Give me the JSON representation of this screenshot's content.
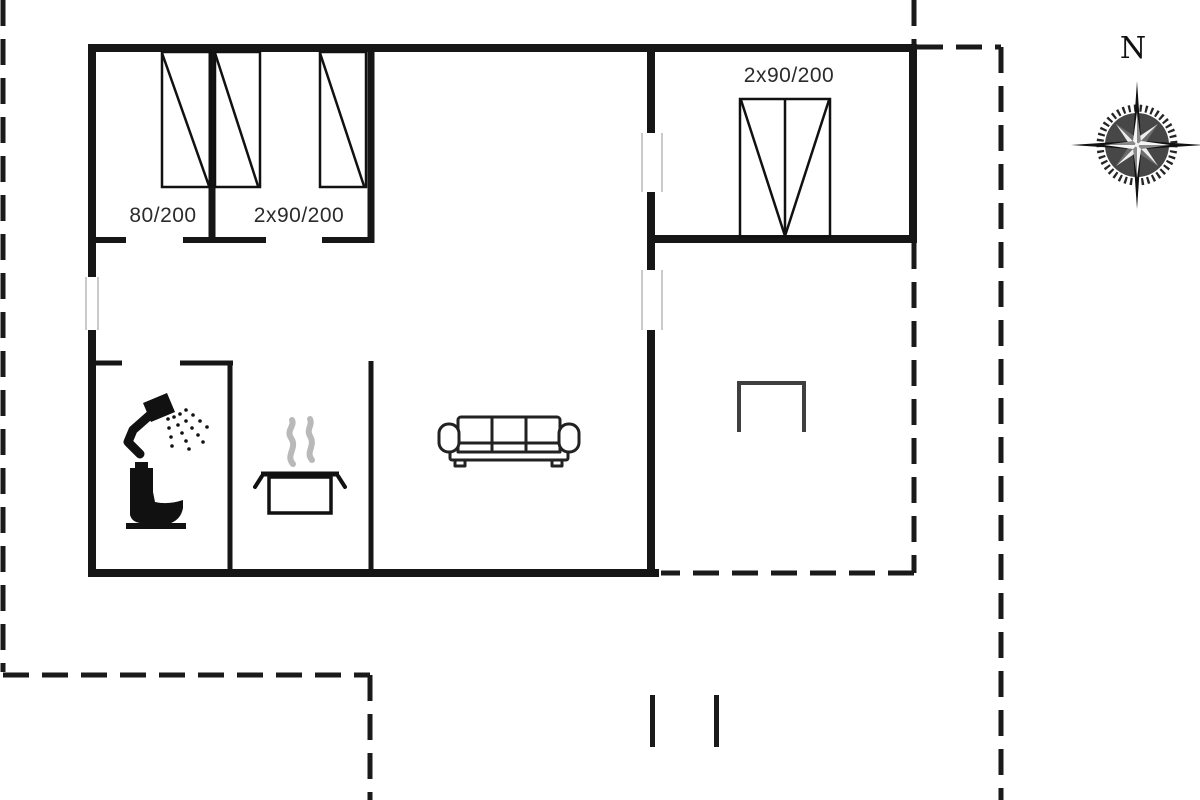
{
  "plan_type": "floor-plan",
  "labels": {
    "bed_single": "80/200",
    "bed_double": "2x90/200",
    "annex_bed_double": "2x90/200"
  },
  "compass": {
    "north": "N"
  },
  "icons": {
    "bathroom": [
      "shower-icon",
      "toilet-icon"
    ],
    "kitchen": [
      "cooking-pot-icon",
      "steam-icon"
    ],
    "living_room": [
      "sofa-icon"
    ],
    "terrace": [
      "table-icon"
    ],
    "orientation": [
      "compass-rose-icon"
    ]
  },
  "colors": {
    "wall": "#161616",
    "thin_line": "#111111",
    "text": "#2b2b2b",
    "steam": "#b9b9b9",
    "window_frame": "#c4c4c4",
    "dashed_boundary": "#1a1a1a",
    "background": "#ffffff"
  }
}
